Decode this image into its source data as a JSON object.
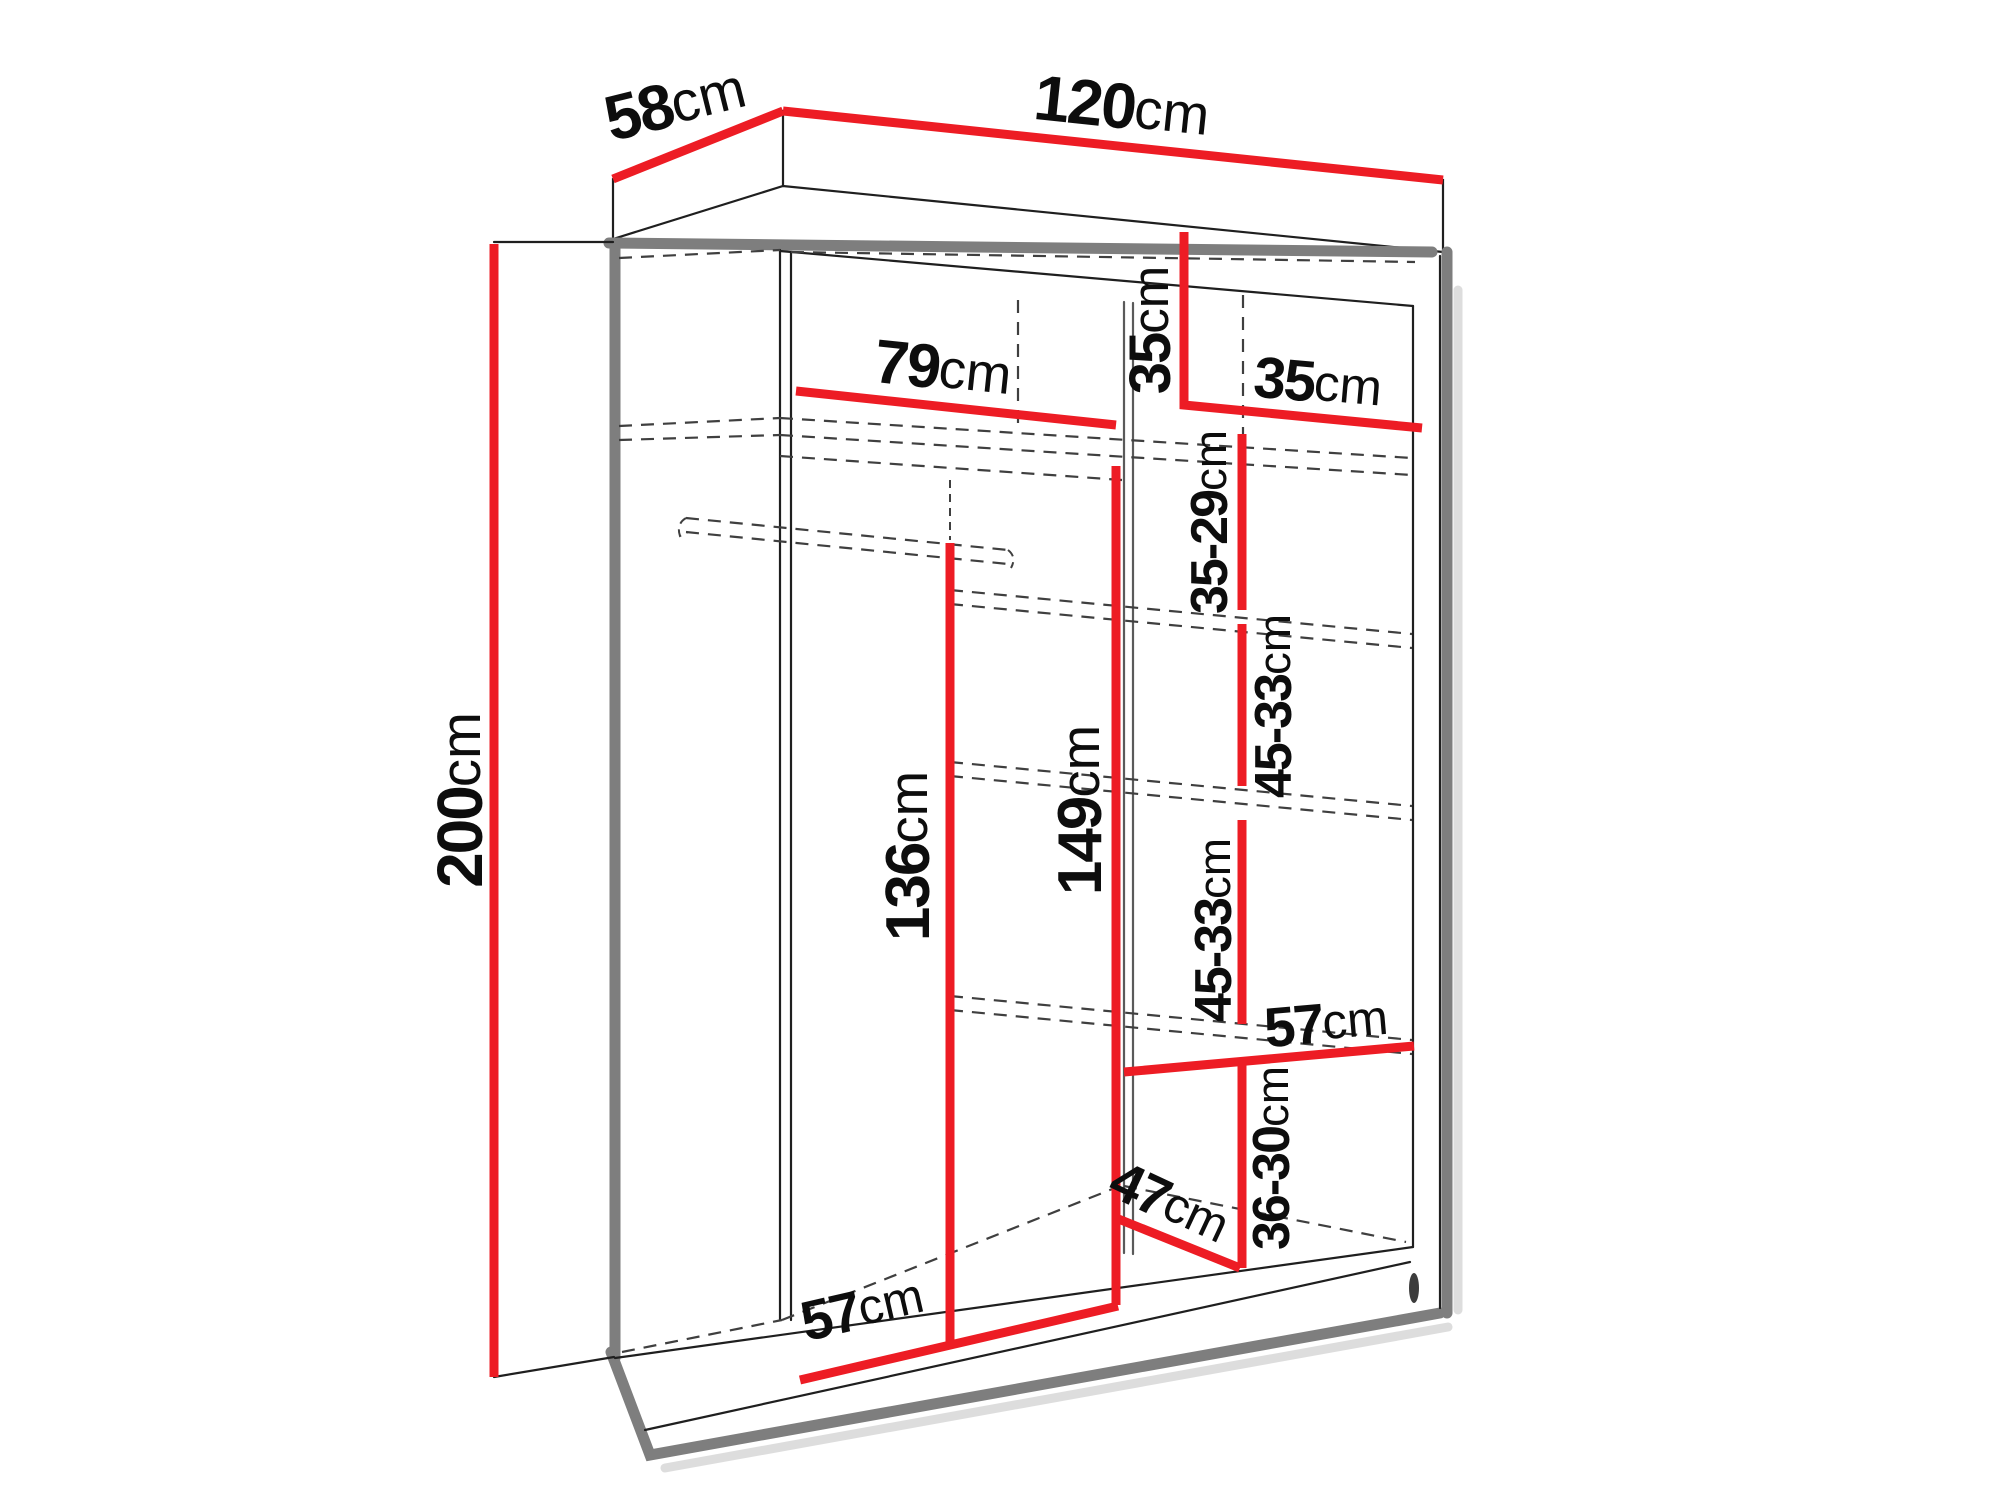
{
  "diagram": {
    "type": "wardrobe-dimension-diagram",
    "unit": "cm",
    "colors": {
      "dimension_line": "#ed1c24",
      "structure_edge": "#7e7e7e",
      "hidden_edge": "#3f3f3f",
      "text": "#0d0d0d",
      "background": "#ffffff"
    },
    "dimensions": {
      "depth": {
        "value": "58",
        "unit": "cm"
      },
      "width": {
        "value": "120",
        "unit": "cm"
      },
      "height": {
        "value": "200",
        "unit": "cm"
      },
      "left_section_width": {
        "value": "79",
        "unit": "cm"
      },
      "top_right_height": {
        "value": "35",
        "unit": "cm"
      },
      "top_right_width": {
        "value": "35",
        "unit": "cm"
      },
      "shelf_gap_1": {
        "value": "35-29",
        "unit": "cm"
      },
      "shelf_gap_2": {
        "value": "45-33",
        "unit": "cm"
      },
      "shelf_gap_3": {
        "value": "45-33",
        "unit": "cm"
      },
      "shelf_gap_4": {
        "value": "36-30",
        "unit": "cm"
      },
      "left_section_height": {
        "value": "136",
        "unit": "cm"
      },
      "middle_section_height": {
        "value": "149",
        "unit": "cm"
      },
      "right_shelf_width": {
        "value": "57",
        "unit": "cm"
      },
      "bottom_compartment_depth": {
        "value": "47",
        "unit": "cm"
      },
      "bottom_left_width": {
        "value": "57",
        "unit": "cm"
      }
    }
  }
}
